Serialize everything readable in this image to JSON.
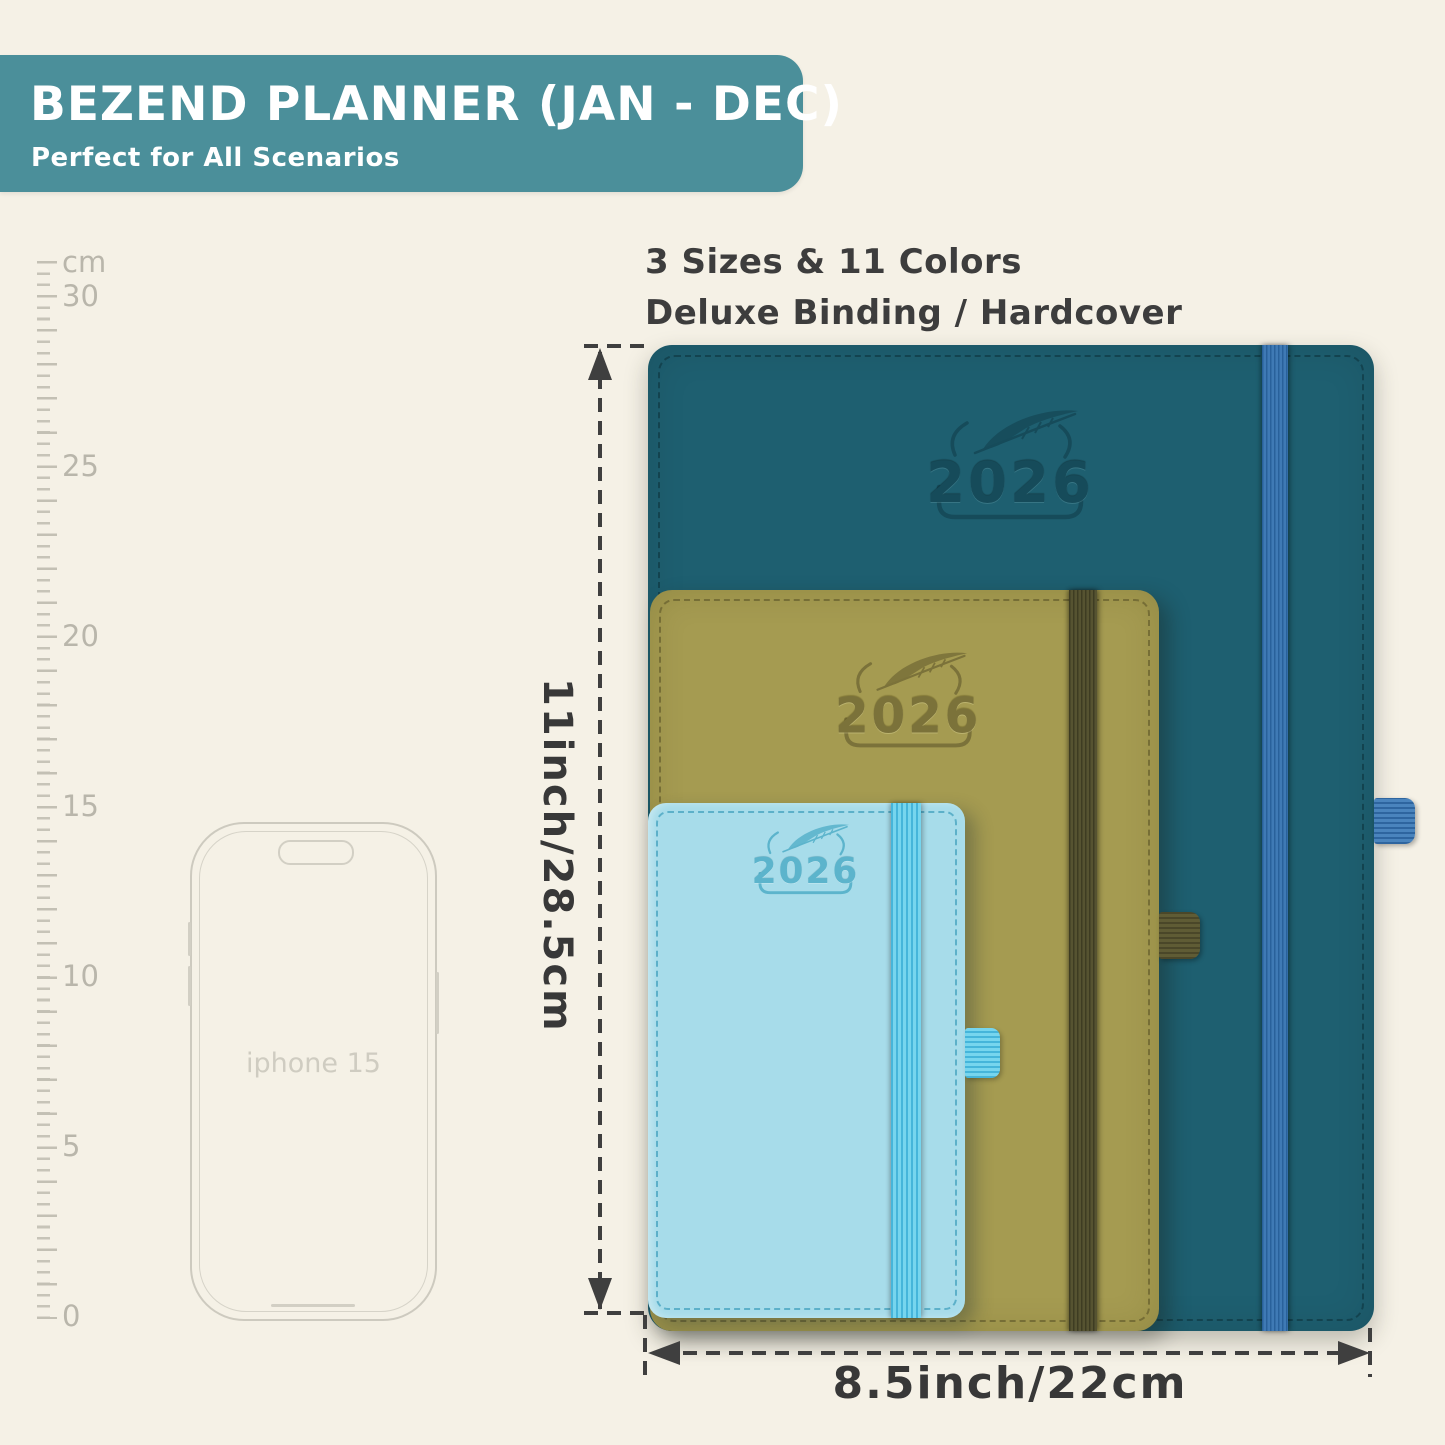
{
  "banner": {
    "title": "BEZEND PLANNER (JAN - DEC)",
    "subtitle": "Perfect for All Scenarios",
    "bg_color": "#4b8f9a",
    "text_color": "#ffffff"
  },
  "headline": {
    "line1": "3 Sizes & 11 Colors",
    "line2": "Deluxe Binding / Hardcover"
  },
  "ruler": {
    "unit": "cm",
    "tick_labels": [
      "cm",
      "30",
      "25",
      "20",
      "15",
      "10",
      "5",
      "0"
    ]
  },
  "phone": {
    "label": "iphone 15"
  },
  "planners": [
    {
      "size": "large",
      "year": "2026",
      "cover_color": "#1e5f70",
      "band_color": "#33699f"
    },
    {
      "size": "medium",
      "year": "2026",
      "cover_color": "#a59b51",
      "band_color": "#4a482c"
    },
    {
      "size": "small",
      "year": "2026",
      "cover_color": "#a7dcea",
      "band_color": "#57c7e7"
    }
  ],
  "dimensions": {
    "height_label": "11inch/28.5cm",
    "width_label": "8.5inch/22cm"
  },
  "background_color": "#f5f1e6",
  "annotation_color": "#3f3f3f"
}
